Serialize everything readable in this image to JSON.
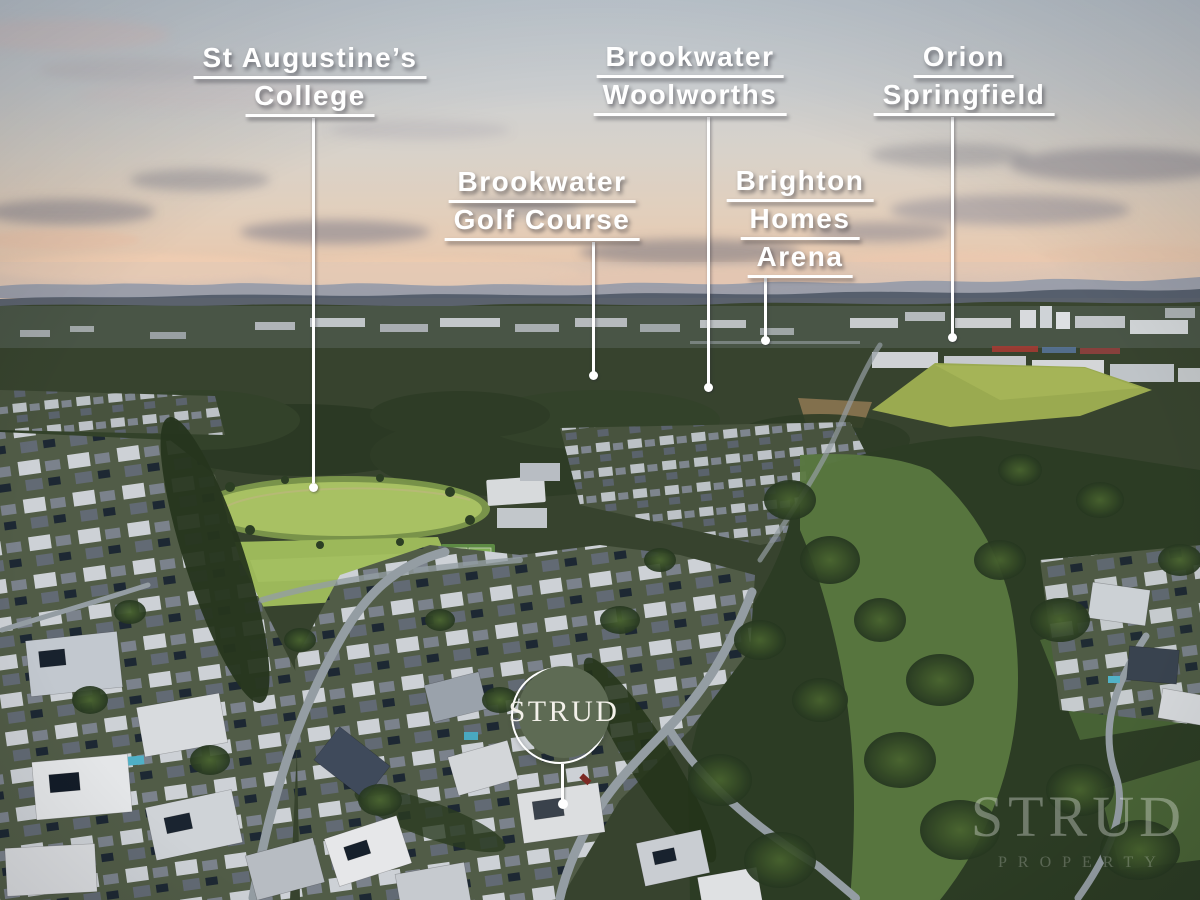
{
  "labels": [
    {
      "id": "st-augustines-college",
      "lines": [
        "St Augustine’s",
        "College"
      ]
    },
    {
      "id": "brookwater-golf-course",
      "lines": [
        "Brookwater",
        "Golf Course"
      ]
    },
    {
      "id": "brookwater-woolworths",
      "lines": [
        "Brookwater",
        "Woolworths"
      ]
    },
    {
      "id": "brighton-homes-arena",
      "lines": [
        "Brighton",
        "Homes",
        "Arena"
      ]
    },
    {
      "id": "orion-springfield",
      "lines": [
        "Orion",
        "Springfield"
      ]
    }
  ],
  "badge": {
    "text": "STRUD"
  },
  "watermark": {
    "title": "STRUD",
    "subtitle": "PROPERTY"
  },
  "colors": {
    "badge": "#5e6b54",
    "label_text": "#ffffff"
  }
}
